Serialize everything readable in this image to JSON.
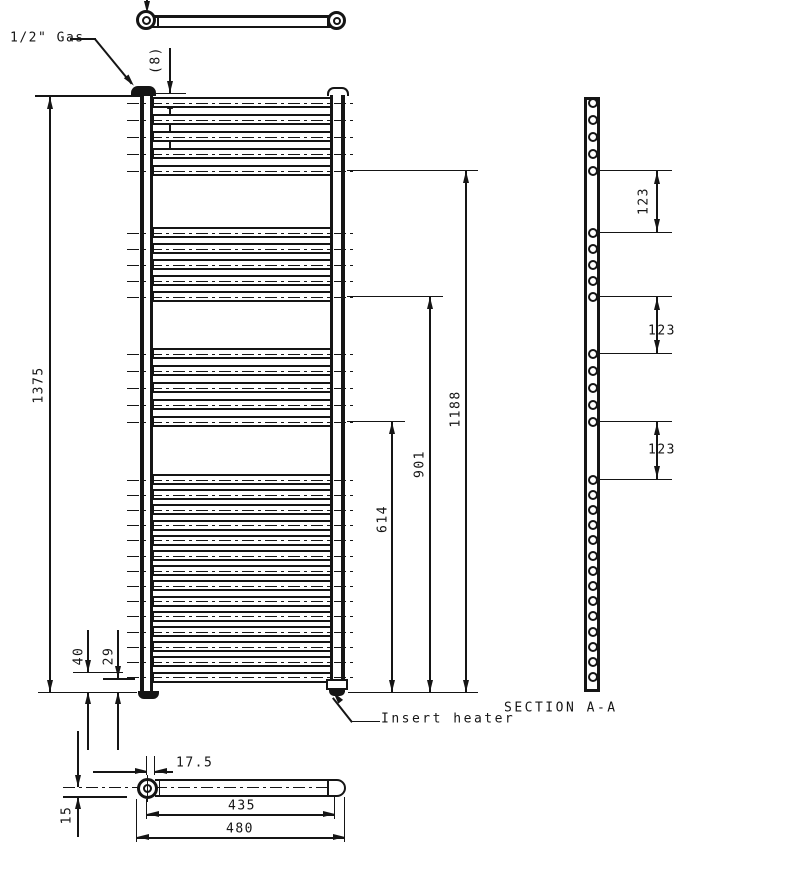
{
  "drawing": {
    "labels": {
      "gas_connection": "1/2\" Gas",
      "insert_heater": "Insert heater",
      "section_title": "SECTION A-A"
    },
    "dims": {
      "top_offset": "(8)",
      "overall_height": "1375",
      "height_1188": "1188",
      "height_901": "901",
      "height_614": "614",
      "bottom_40": "40",
      "bottom_29": "29",
      "gap_1": "123",
      "gap_2": "123",
      "gap_3": "123",
      "end_offset": "17.5",
      "centres_width": "435",
      "overall_width": "480",
      "depth_15": "15"
    },
    "geometry": {
      "tube_groups": [
        {
          "start": 97,
          "count": 5,
          "pitch": 17
        },
        {
          "start": 227,
          "count": 5,
          "pitch": 16
        },
        {
          "start": 348,
          "count": 5,
          "pitch": 17
        },
        {
          "start": 474,
          "count": 14,
          "pitch": 15.2
        }
      ],
      "tube_height": 11,
      "line_color": "#151515"
    }
  }
}
